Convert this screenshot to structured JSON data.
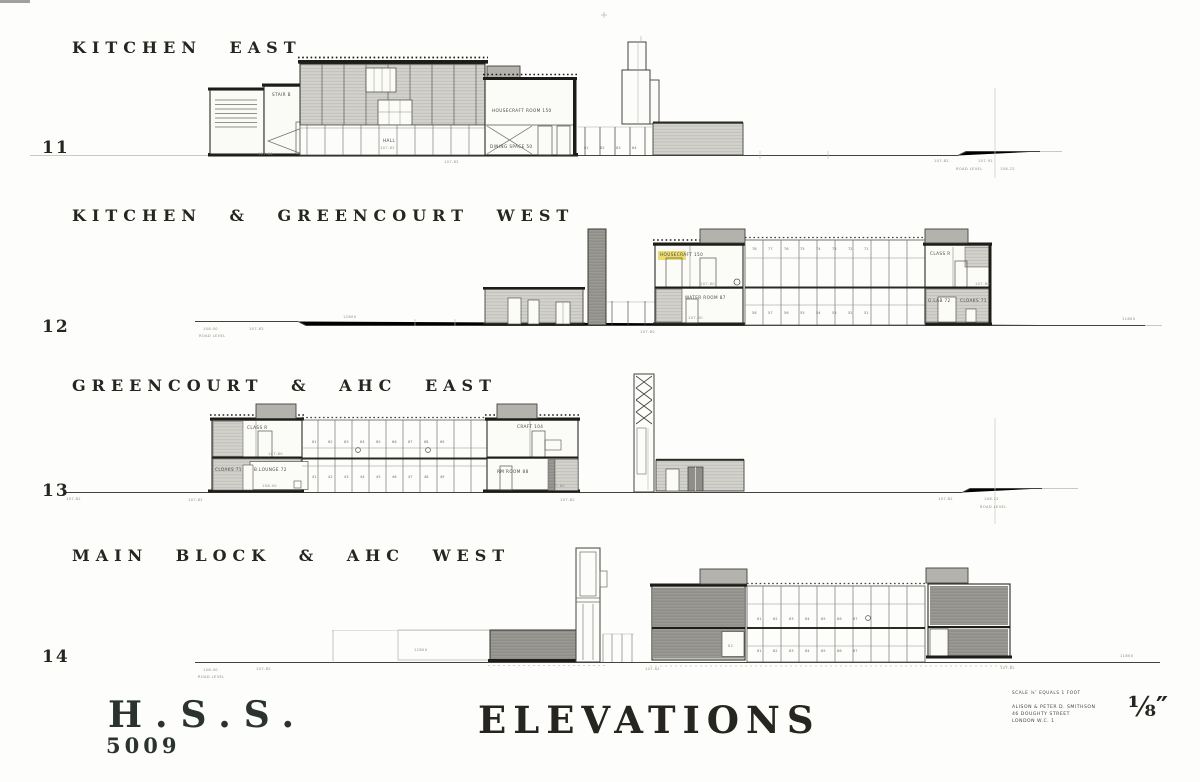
{
  "sheet": {
    "background": "#fdfdfb",
    "ink": "#2b2a25",
    "highlight_yellow": "#e8d44d"
  },
  "titleblock": {
    "project_code": "H.S.S.",
    "drawing_number": "5009",
    "sheet_title": "ELEVATIONS",
    "scale_fraction": "⅛″"
  },
  "credits": {
    "scale_note": "SCALE ⅛″ EQUALS 1 FOOT",
    "line1": "ALISON & PETER D. SMITHSON",
    "line2": "46 DOUGHTY STREET",
    "line3": "LONDON W.C. 1"
  },
  "rows": [
    {
      "number": "11",
      "title": "KITCHEN EAST",
      "labels": [
        {
          "x": 272,
          "y": 92,
          "t": "STAIR B"
        },
        {
          "x": 383,
          "y": 138,
          "t": "HALL"
        },
        {
          "x": 380,
          "y": 146,
          "t": "107.82",
          "c": "lt"
        },
        {
          "x": 492,
          "y": 108,
          "t": "HOUSECRAFT ROOM 150"
        },
        {
          "x": 490,
          "y": 144,
          "t": "DINING SPACE 50"
        },
        {
          "x": 584,
          "y": 146,
          "t": "61 62 63 64",
          "spread": true
        },
        {
          "x": 444,
          "y": 160,
          "t": "107.82",
          "c": "lt"
        },
        {
          "x": 258,
          "y": 152,
          "t": "107.80",
          "c": "lt"
        },
        {
          "x": 934,
          "y": 159,
          "t": "107.82",
          "c": "lt"
        },
        {
          "x": 978,
          "y": 159,
          "t": "107.92",
          "c": "lt"
        },
        {
          "x": 956,
          "y": 167,
          "t": "ROAD LEVEL",
          "c": "lt"
        },
        {
          "x": 1000,
          "y": 167,
          "t": "108.22",
          "c": "lt"
        }
      ]
    },
    {
      "number": "12",
      "title": "KITCHEN & GREENCOURT WEST",
      "labels": [
        {
          "x": 203,
          "y": 327,
          "t": "108.00",
          "c": "lt"
        },
        {
          "x": 199,
          "y": 334,
          "t": "ROAD LEVEL",
          "c": "lt"
        },
        {
          "x": 249,
          "y": 327,
          "t": "107.82",
          "c": "lt"
        },
        {
          "x": 343,
          "y": 315,
          "t": "12800",
          "c": "lt"
        },
        {
          "x": 660,
          "y": 252,
          "t": "HOUSECRAFT 150"
        },
        {
          "x": 700,
          "y": 282,
          "t": "107.80",
          "c": "lt"
        },
        {
          "x": 685,
          "y": 295,
          "t": "WATER ROOM 87"
        },
        {
          "x": 688,
          "y": 316,
          "t": "107.80",
          "c": "lt"
        },
        {
          "x": 930,
          "y": 251,
          "t": "CLASS R"
        },
        {
          "x": 975,
          "y": 282,
          "t": "107.80",
          "c": "lt"
        },
        {
          "x": 928,
          "y": 298,
          "t": "G.LAB 72"
        },
        {
          "x": 960,
          "y": 298,
          "t": "CLOAKS 71"
        },
        {
          "x": 752,
          "y": 247,
          "t": "78 77 76 75 74 73 72 71",
          "spread": true
        },
        {
          "x": 752,
          "y": 311,
          "t": "58 57 56 55 54 53 52 51",
          "spread": true
        },
        {
          "x": 640,
          "y": 330,
          "t": "107.80",
          "c": "lt"
        },
        {
          "x": 1122,
          "y": 317,
          "t": "11800",
          "c": "lt"
        }
      ]
    },
    {
      "number": "13",
      "title": "GREENCOURT & AHC EAST",
      "labels": [
        {
          "x": 66,
          "y": 497,
          "t": "107.82",
          "c": "lt"
        },
        {
          "x": 188,
          "y": 498,
          "t": "107.82",
          "c": "lt"
        },
        {
          "x": 247,
          "y": 425,
          "t": "CLASS R"
        },
        {
          "x": 268,
          "y": 452,
          "t": "107.80",
          "c": "lt"
        },
        {
          "x": 215,
          "y": 467,
          "t": "CLOAKS 71"
        },
        {
          "x": 254,
          "y": 467,
          "t": "B.LOUNGE 72"
        },
        {
          "x": 262,
          "y": 484,
          "t": "108.00",
          "c": "lt"
        },
        {
          "x": 312,
          "y": 440,
          "t": "61 62 63 64 65 66 67 68 69",
          "spread": true
        },
        {
          "x": 312,
          "y": 475,
          "t": "41 42 43 44 45 46 47 48 49",
          "spread": true
        },
        {
          "x": 517,
          "y": 424,
          "t": "CRAFT 104"
        },
        {
          "x": 497,
          "y": 469,
          "t": "RM ROOM 88"
        },
        {
          "x": 550,
          "y": 484,
          "t": "107.80",
          "c": "lt"
        },
        {
          "x": 560,
          "y": 498,
          "t": "107.82",
          "c": "lt"
        },
        {
          "x": 938,
          "y": 497,
          "t": "107.82",
          "c": "lt"
        },
        {
          "x": 984,
          "y": 497,
          "t": "108.22",
          "c": "lt"
        },
        {
          "x": 980,
          "y": 505,
          "t": "ROAD LEVEL",
          "c": "lt"
        }
      ]
    },
    {
      "number": "14",
      "title": "MAIN BLOCK & AHC WEST",
      "labels": [
        {
          "x": 203,
          "y": 668,
          "t": "108.00",
          "c": "lt"
        },
        {
          "x": 198,
          "y": 675,
          "t": "ROAD LEVEL",
          "c": "lt"
        },
        {
          "x": 256,
          "y": 667,
          "t": "107.82",
          "c": "lt"
        },
        {
          "x": 414,
          "y": 648,
          "t": "12800",
          "c": "lt"
        },
        {
          "x": 645,
          "y": 667,
          "t": "107.82",
          "c": "lt"
        },
        {
          "x": 728,
          "y": 644,
          "t": "82",
          "c": "lt"
        },
        {
          "x": 757,
          "y": 617,
          "t": "61 62 63 64 65 66 67",
          "spread": true
        },
        {
          "x": 757,
          "y": 649,
          "t": "81 82 83 84 85 86 87",
          "spread": true
        },
        {
          "x": 1120,
          "y": 654,
          "t": "11800",
          "c": "lt"
        },
        {
          "x": 1000,
          "y": 666,
          "t": "107.82",
          "c": "lt"
        }
      ]
    }
  ]
}
